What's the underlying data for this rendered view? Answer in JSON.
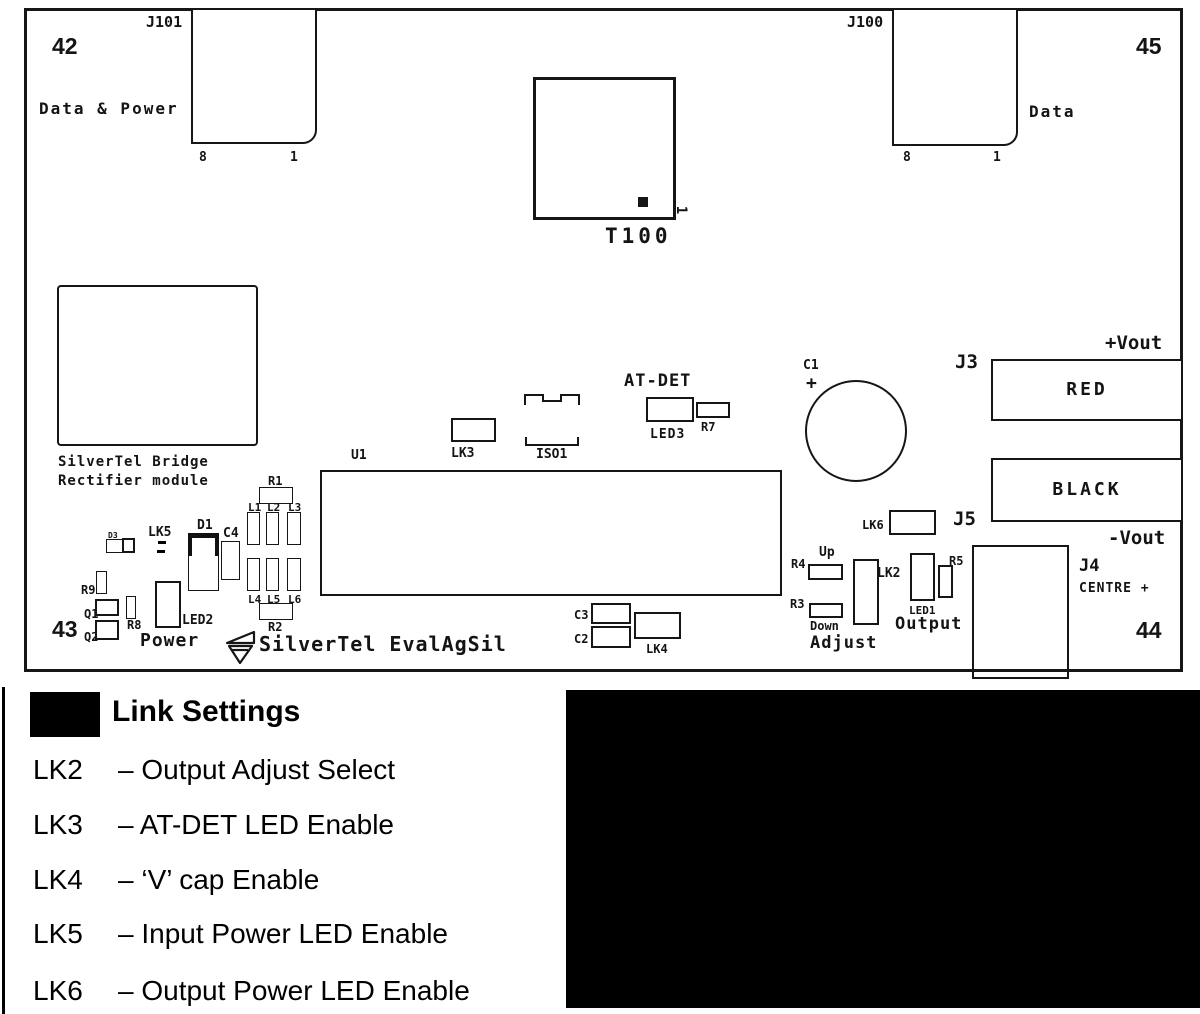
{
  "colors": {
    "ink": "#141414",
    "fill_black": "#000000",
    "background": "#ffffff"
  },
  "board": {
    "ref_42": "42",
    "ref_43": "43",
    "ref_44": "44",
    "ref_45": "45",
    "j101": {
      "label": "J101",
      "caption": "Data & Power",
      "pin8": "8",
      "pin1": "1"
    },
    "j100": {
      "label": "J100",
      "caption": "Data",
      "pin8": "8",
      "pin1": "1"
    },
    "t100": {
      "label": "T100",
      "pin1": "1"
    },
    "bridge": {
      "line1": "SilverTel Bridge",
      "line2": "Rectifier module"
    },
    "u1": "U1",
    "lk3": "LK3",
    "iso1": "ISO1",
    "atdet": "AT-DET",
    "led3": "LED3",
    "r7": "R7",
    "c1": "C1",
    "c1_plus": "+",
    "j3": "J3",
    "red": "RED",
    "black": "BLACK",
    "j5": "J5",
    "vout_plus": "+Vout",
    "vout_minus": "-Vout",
    "lk6": "LK6",
    "r4": "R4",
    "up": "Up",
    "r3": "R3",
    "down": "Down",
    "adjust": "Adjust",
    "lk2": "LK2",
    "led1": "LED1",
    "r5": "R5",
    "output": "Output",
    "j4": {
      "label": "J4",
      "centre": "CENTRE +"
    },
    "d3": "D3",
    "lk5": "LK5",
    "d1": "D1",
    "c4": "C4",
    "r9": "R9",
    "q1": "Q1",
    "q2": "Q2",
    "r8": "R8",
    "led2": "LED2",
    "power": "Power",
    "r1": "R1",
    "r2": "R2",
    "l1": "L1",
    "l2": "L2",
    "l3": "L3",
    "l4": "L4",
    "l5": "L5",
    "l6": "L6",
    "brand": "SilverTel EvalAgSil",
    "c3": "C3",
    "c2": "C2",
    "lk4": "LK4"
  },
  "legend": {
    "title": "Link Settings",
    "rows": [
      {
        "key": "LK2",
        "desc": "– Output Adjust Select"
      },
      {
        "key": "LK3",
        "desc": "– AT-DET LED Enable"
      },
      {
        "key": "LK4",
        "desc": "– ‘V’ cap Enable"
      },
      {
        "key": "LK5",
        "desc": "– Input Power LED Enable"
      },
      {
        "key": "LK6",
        "desc": "– Output Power LED Enable"
      }
    ]
  }
}
